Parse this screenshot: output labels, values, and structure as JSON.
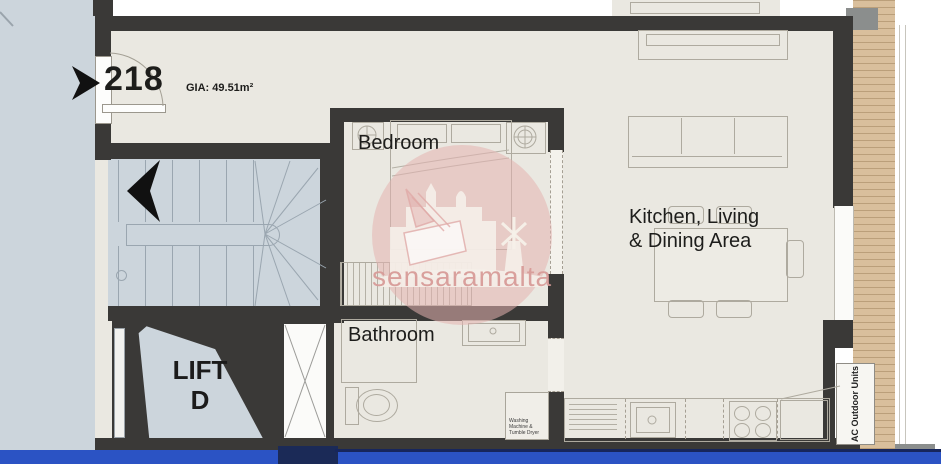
{
  "plan": {
    "unit_number": "218",
    "gia_label": "GIA: 49.51m²",
    "rooms": {
      "bedroom": "Bedroom",
      "bathroom": "Bathroom",
      "kitchen_living_line1": "Kitchen, Living",
      "kitchen_living_line2": "& Dining Area",
      "lift_line1": "LIFT",
      "lift_line2": "D"
    },
    "annotations": {
      "ac_units": "AC Outdoor Units",
      "washer": "Washing Machine & Tumble Dryer"
    },
    "watermark": "sensaramalta",
    "colors": {
      "wall": "#3a3937",
      "floor": "#eae8e1",
      "common_area": "#ccd5dc",
      "deck_wood": "#d9bf9c",
      "street_blue": "#2b53c4",
      "watermark_pink": "#e2b0ae"
    }
  }
}
